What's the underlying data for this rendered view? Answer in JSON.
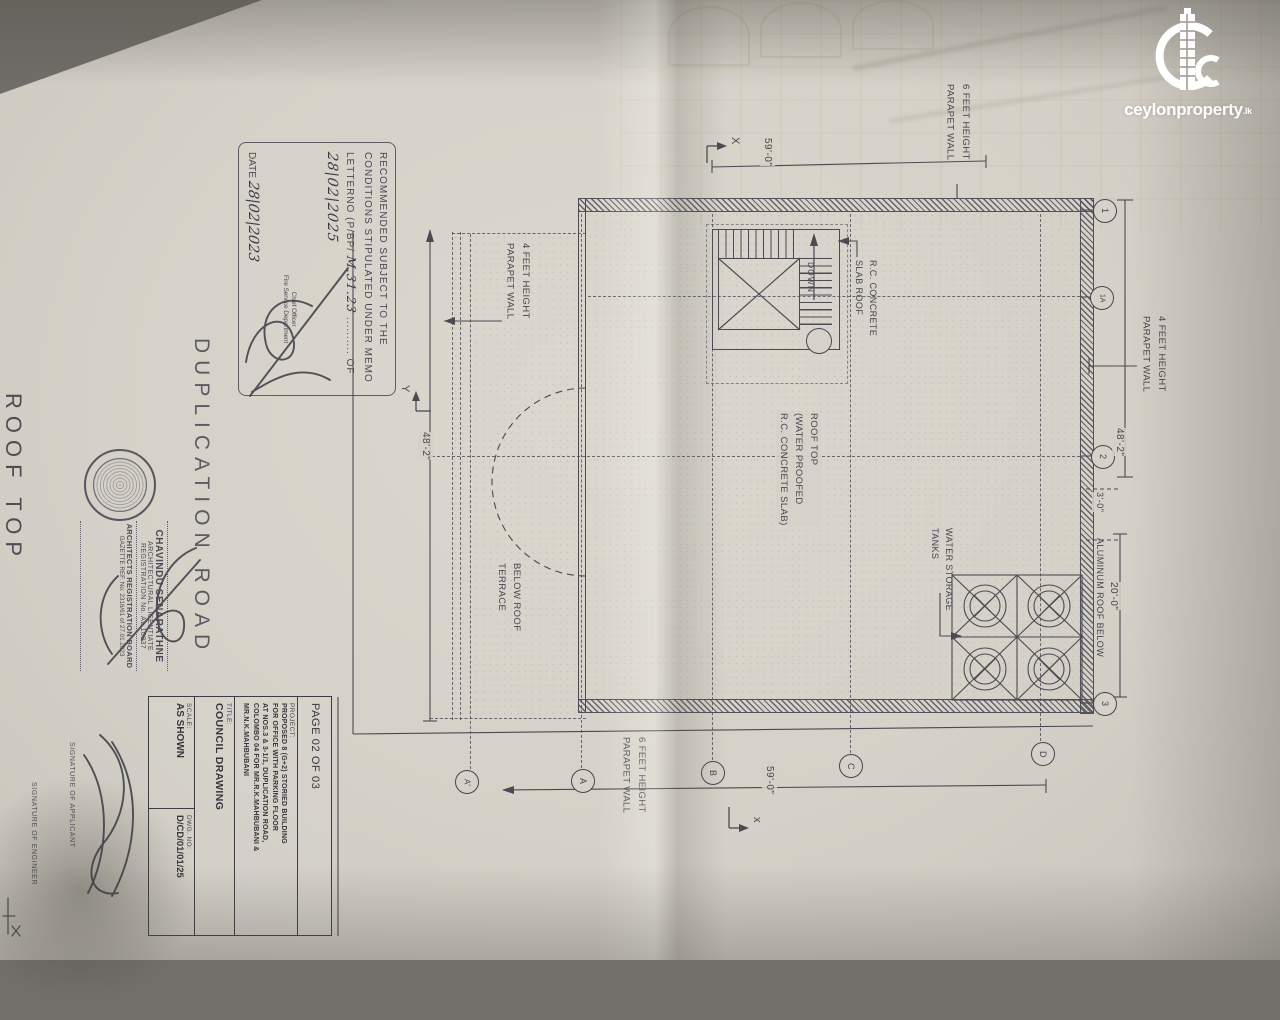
{
  "logo": {
    "brand_bold": "ceylon",
    "brand_light": "property",
    "tld": ".lk"
  },
  "titles": {
    "road": "DUPLICATION  ROAD",
    "sheet": "ROOF  TOP"
  },
  "fire_stamp": {
    "line1": "RECOMMENDED  SUBJECT  TO  THE",
    "line2": "CONDITIONS STIPULATED UNDER MEMO",
    "line3_prefix": "LETTERNO (P/BP/",
    "line3_hw": "M.31.23",
    "line3_dots": "..........",
    "line3_suffix": "OF",
    "line4_hw": "28|02|2025",
    "date_label": "DATE",
    "date_hw": "28|02|2023",
    "officer": "Chief Officer",
    "dept": "Fire Service Department"
  },
  "architect_stamp": {
    "name": "CHAVINDU SENARATHNE",
    "line2": "ARCHITECTURAL LICENTIATE",
    "line3": "REGISTRATION No. AL 10037",
    "line4": "ARCHITECTS REGISTRATION BOARD",
    "line5": "GAZETTE REF. No: 2316/61 of 27.01.2023"
  },
  "signatures": {
    "applicant": "SIGNATURE OF APPLICANT",
    "engineer": "SIGNATURE OF ENGINEER"
  },
  "title_block": {
    "page": "PAGE 02 OF 03",
    "project_label": "PROJECT:",
    "project": [
      "PROPOSED 8 (G+2) STORIED BUILDING",
      "FOR OFFICE WITH PARKING FLOOR",
      "AT NOS.3 & 3-1/1, DUPLICATION ROAD,",
      "COLOMBO 04 FOR MR.R.K.MAHBUBANI &",
      "MR.N.K.MAHBUBANI"
    ],
    "title_label": "TITLE:",
    "title": "COUNCIL DRAWING",
    "scale_label": "SCALE:",
    "scale": "AS SHOWN",
    "dwg_label": "DWG. NO:",
    "dwg_no": "D/CD/01/01/25"
  },
  "plan": {
    "labels": {
      "parapet6": "6 FEET HEIGHT\nPARAPET WALL",
      "parapet4": "4 FEET HEIGHT\nPARAPET WALL",
      "roof_top": "ROOF TOP\n(WATER PROOFED\nR.C. CONCRETE SLAB)",
      "rc_slab": "R.C. CONCRETE\nSLAB ROOF",
      "terrace": "BELOW ROOF\nTERRACE",
      "tanks": "WATER STORAGE\nTANKS",
      "aluminum": "ALUMINUM ROOF BELOW",
      "down": "DOWN"
    },
    "dims": {
      "top": "59'-0\"",
      "bottom": "59'-0\"",
      "left": "48'-2\"",
      "right_upper": "48'-2\"",
      "right_mid": "3'-0\"",
      "right_lower": "20'-0\""
    },
    "grid": {
      "right": [
        "1",
        "1A",
        "2",
        "3"
      ],
      "bottom": [
        "A'",
        "A",
        "B",
        "C",
        "D"
      ]
    },
    "axes": {
      "x": "X",
      "y": "Y",
      "x2": "x"
    }
  },
  "colors": {
    "ink": "#4a4a52",
    "paper": "#d5d1c8",
    "logo": "#ffffff"
  }
}
